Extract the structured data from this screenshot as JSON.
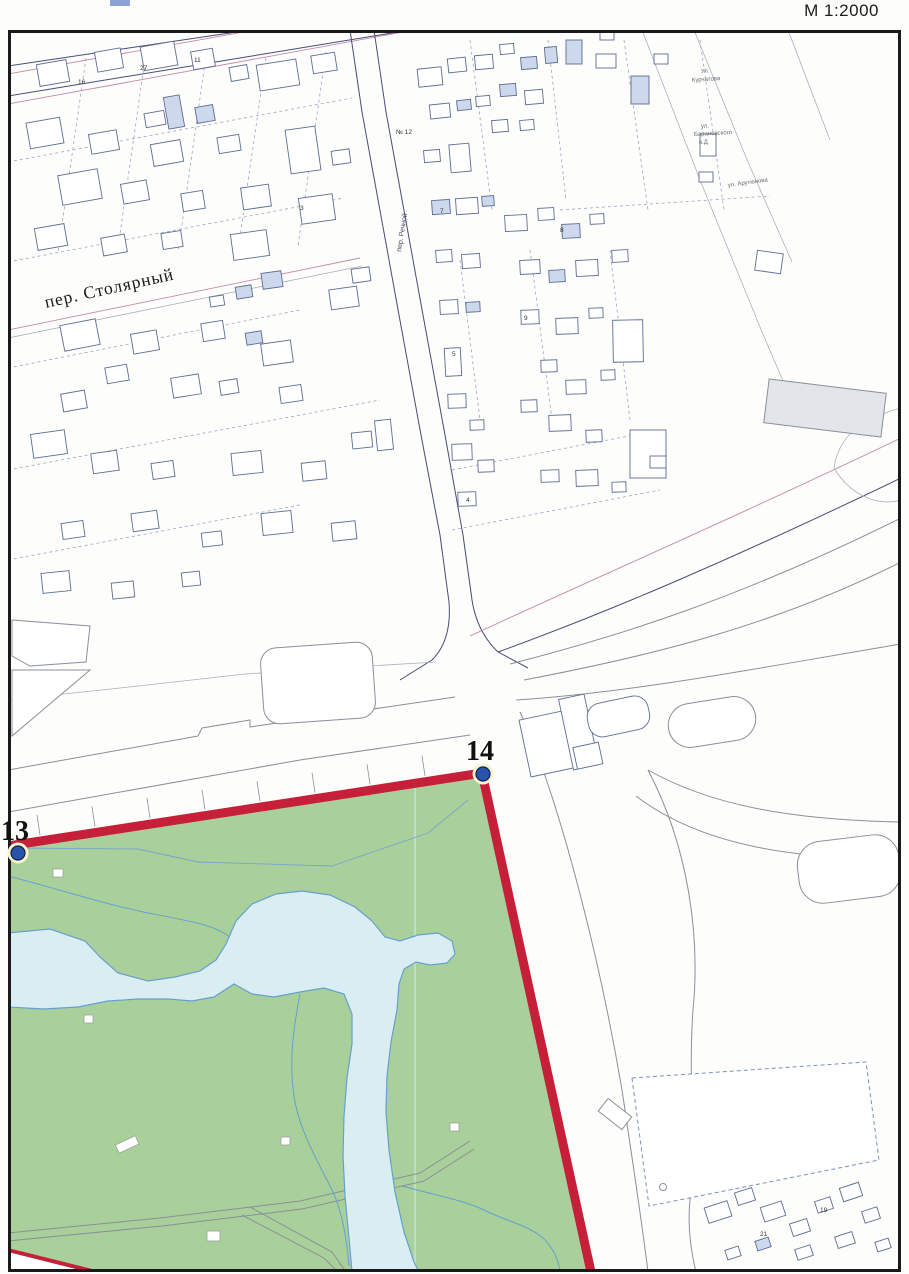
{
  "scale_label": "М 1:2000",
  "street_labels": [
    {
      "text": "пер. Столярный",
      "x": 46,
      "y": 308,
      "rot": -12.5,
      "size": 17.5,
      "color": "#1a1a1a",
      "serif": true
    },
    {
      "text": "пер. Речной",
      "x": 401,
      "y": 252,
      "rot": -81,
      "size": 7,
      "color": "#4a4a66",
      "serif": false
    },
    {
      "text": "Ул.",
      "x": 701,
      "y": 73,
      "rot": -4,
      "size": 6,
      "color": "#666a72",
      "serif": false
    },
    {
      "text": "Курчатова",
      "x": 692,
      "y": 82,
      "rot": -4,
      "size": 6,
      "color": "#666a72",
      "serif": false
    },
    {
      "text": "ул.",
      "x": 701,
      "y": 128,
      "rot": -3,
      "size": 6,
      "color": "#666a72",
      "serif": false
    },
    {
      "text": "Барановского",
      "x": 694,
      "y": 136,
      "rot": -3,
      "size": 6,
      "color": "#666a72",
      "serif": false
    },
    {
      "text": "в.Д",
      "x": 699,
      "y": 144,
      "rot": -3,
      "size": 6,
      "color": "#666a72",
      "serif": false
    },
    {
      "text": "ул. Арутюнова",
      "x": 728,
      "y": 187,
      "rot": -8,
      "size": 6,
      "color": "#666a72",
      "serif": false
    }
  ],
  "boundary": {
    "points": [
      {
        "label": "13",
        "x": 18,
        "y": 853,
        "lx": 1,
        "ly": 840
      },
      {
        "label": "14",
        "x": 483,
        "y": 774,
        "lx": 466,
        "ly": 760
      }
    ]
  },
  "map_labels": [
    {
      "text": "16",
      "x": 78,
      "y": 84
    },
    {
      "text": "27",
      "x": 140,
      "y": 70
    },
    {
      "text": "11",
      "x": 194,
      "y": 62
    },
    {
      "text": "№ 12",
      "x": 396,
      "y": 134
    },
    {
      "text": "7",
      "x": 440,
      "y": 213
    },
    {
      "text": "8",
      "x": 560,
      "y": 232
    },
    {
      "text": "9",
      "x": 524,
      "y": 320
    },
    {
      "text": "5",
      "x": 452,
      "y": 356
    },
    {
      "text": "3",
      "x": 300,
      "y": 210
    },
    {
      "text": "4",
      "x": 466,
      "y": 502
    },
    {
      "text": "19",
      "x": 820,
      "y": 1212
    },
    {
      "text": "21",
      "x": 760,
      "y": 1236
    }
  ],
  "colors": {
    "boundary_red": "#c51f3a",
    "park_green": "#a9d09a",
    "water_fill": "#d9edf2",
    "water_stroke": "#66a0cf",
    "building_stroke": "#5d6c94",
    "masonry_fill": "#ccd8ec",
    "parcel_line": "#98a6c6",
    "road_navy": "#474c78",
    "road_pink": "#c48aa6",
    "gray_line": "#8c8f98",
    "point_fill": "#2753a8",
    "point_halo": "#f7f3cf"
  }
}
